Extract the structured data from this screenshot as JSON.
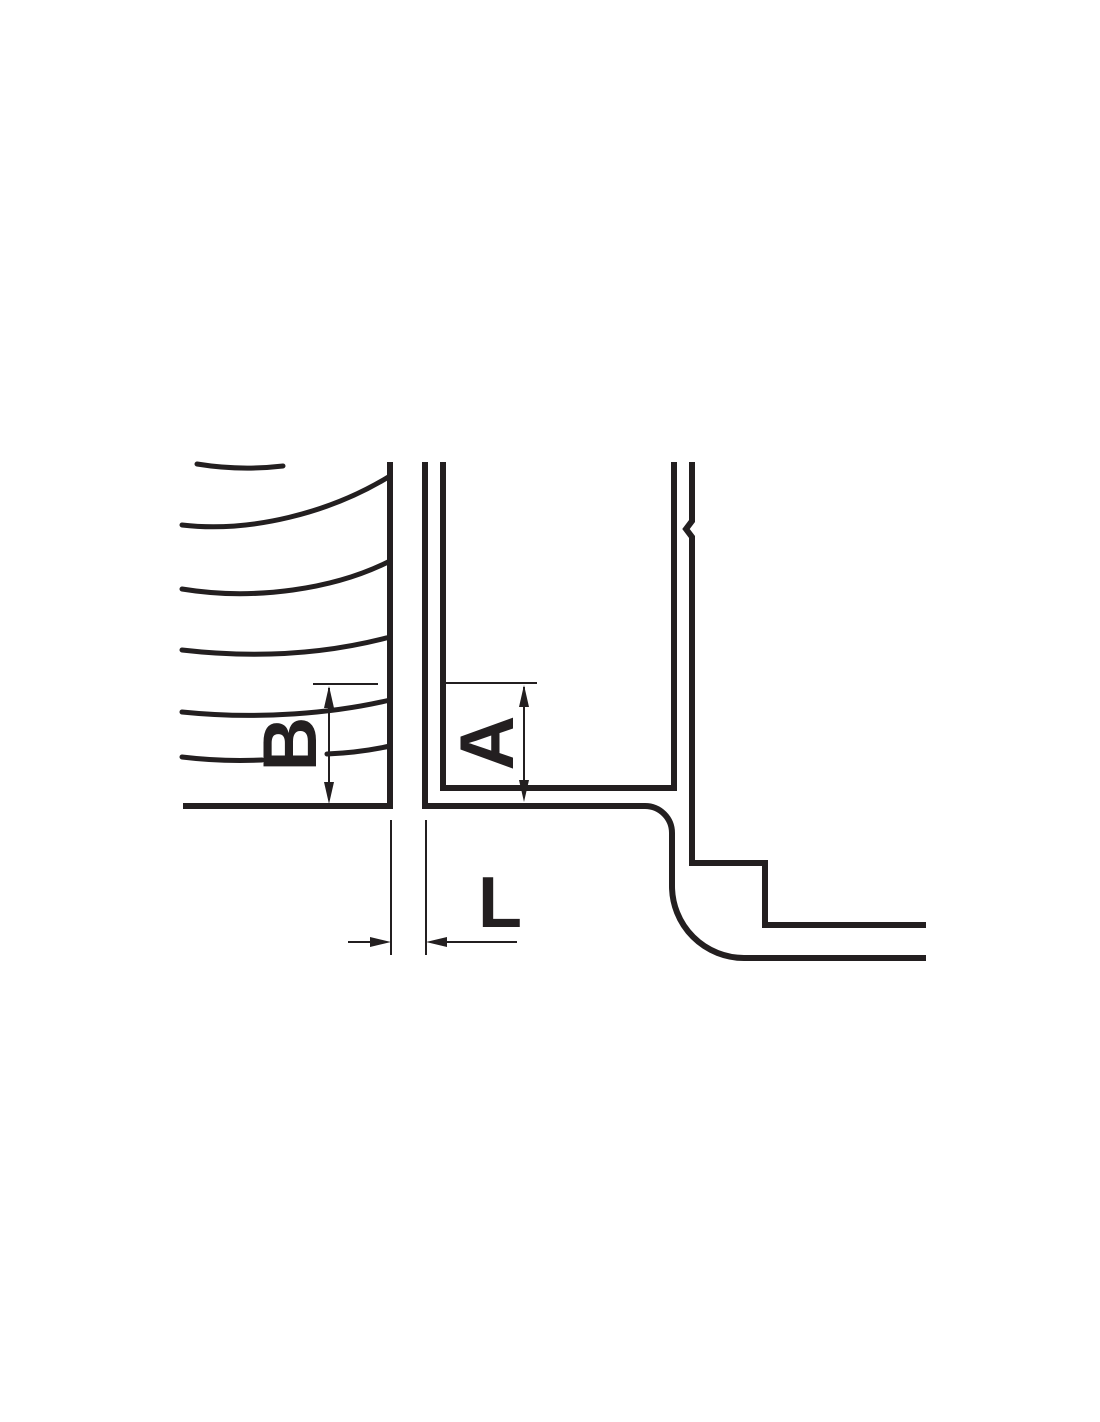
{
  "diagram": {
    "labels": {
      "b": "B",
      "a": "A",
      "l": "L"
    },
    "colors": {
      "line": "#231f20",
      "background": "#ffffff"
    }
  }
}
